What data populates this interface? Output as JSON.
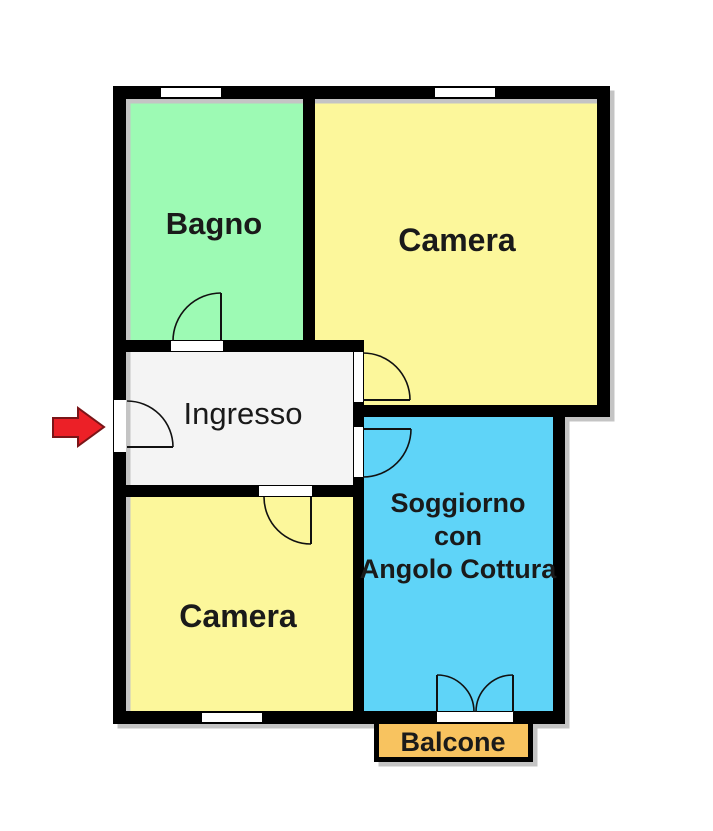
{
  "floorplan": {
    "title": "apartment-floor-plan",
    "rooms": [
      {
        "id": "bagno",
        "label": "Bagno",
        "color": "#9dfab4"
      },
      {
        "id": "camera-top",
        "label": "Camera",
        "color": "#fcf79b"
      },
      {
        "id": "ingresso",
        "label": "Ingresso",
        "color": "#f4f4f4"
      },
      {
        "id": "camera-bottom",
        "label": "Camera",
        "color": "#fcf79b"
      },
      {
        "id": "soggiorno",
        "label": "Soggiorno con Angolo Cottura",
        "label_lines": [
          "Soggiorno",
          "con",
          "Angolo Cottura"
        ],
        "color": "#5fd4f8"
      },
      {
        "id": "balcone",
        "label": "Balcone",
        "color": "#f8c35f"
      }
    ],
    "entrance_arrow": {
      "direction": "right",
      "color": "#ec2027",
      "outline": "#7a1518"
    },
    "palette": {
      "wall_color": "#000000",
      "shadow_color": "#c4c4c4",
      "window_color": "#ffffff",
      "text_color": "#1a1a1a"
    }
  }
}
